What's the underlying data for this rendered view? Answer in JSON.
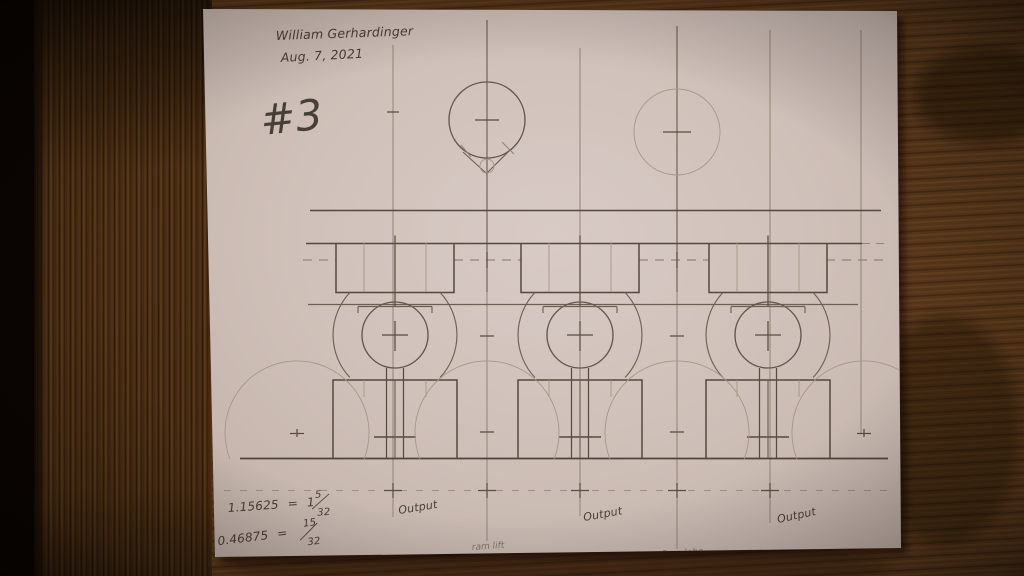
{
  "colors": {
    "paper": "#d2c3bc",
    "paper_edge": "#baa9a0",
    "wood_dark": "#1c0e05",
    "wood_mid": "#4a2c12",
    "wood_light": "#6d4824",
    "graphite_strong": "#4a4036",
    "graphite_medium": "#665a4c",
    "graphite_light": "#8e8073"
  },
  "handwriting": {
    "author": "William Gerhardinger",
    "date": "Aug. 7, 2021",
    "sheet_number": "#3",
    "calc1": {
      "decimal": "1.15625",
      "eq": "=",
      "whole": "1",
      "num": "5",
      "den": "32"
    },
    "calc2": {
      "decimal": "0.46875",
      "eq": "=",
      "num": "15",
      "den": "32"
    },
    "outputs": [
      "Output",
      "Output",
      "Output"
    ],
    "mechanism_labels": [
      "ram lift",
      "Cam lobe"
    ]
  }
}
